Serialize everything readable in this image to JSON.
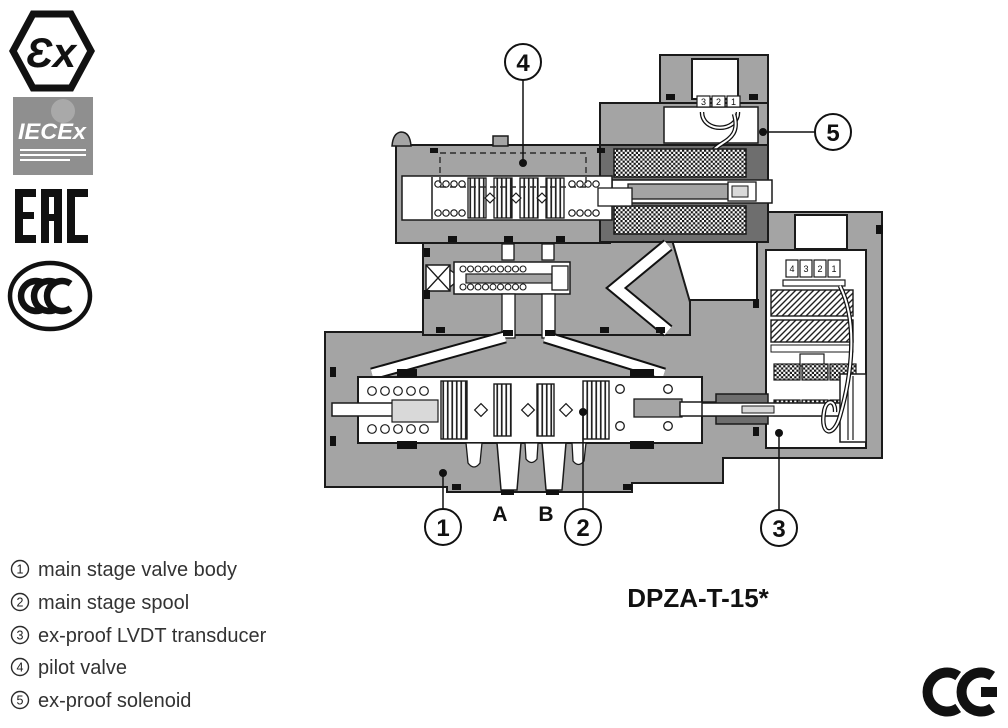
{
  "figure": {
    "model_code": "DPZA-T-15*",
    "port_labels": {
      "a": "A",
      "b": "B"
    },
    "callouts": {
      "c1": {
        "number": "1"
      },
      "c2": {
        "number": "2"
      },
      "c3": {
        "number": "3"
      },
      "c4": {
        "number": "4"
      },
      "c5": {
        "number": "5"
      }
    },
    "solenoid_terminals": [
      "3",
      "2",
      "1"
    ],
    "transducer_terminals": [
      "4",
      "3",
      "2",
      "1"
    ]
  },
  "legend": {
    "items": [
      {
        "number": "1",
        "label": "main stage valve body"
      },
      {
        "number": "2",
        "label": "main stage spool"
      },
      {
        "number": "3",
        "label": "ex-proof LVDT transducer"
      },
      {
        "number": "4",
        "label": "pilot valve"
      },
      {
        "number": "5",
        "label": "ex-proof solenoid"
      }
    ]
  },
  "certifications": {
    "atex": "Ɛx",
    "iecex": "IECEx",
    "eac": "EAC",
    "ccc": "CCC"
  },
  "ce_mark": "CE",
  "colors": {
    "body_gray": "#a4a4a4",
    "dark_gray": "#6e6e6e",
    "light_gray": "#d9d9d9",
    "iecex_gray": "#8f8f8f",
    "outline": "#1a1a1a",
    "text": "#333333"
  }
}
